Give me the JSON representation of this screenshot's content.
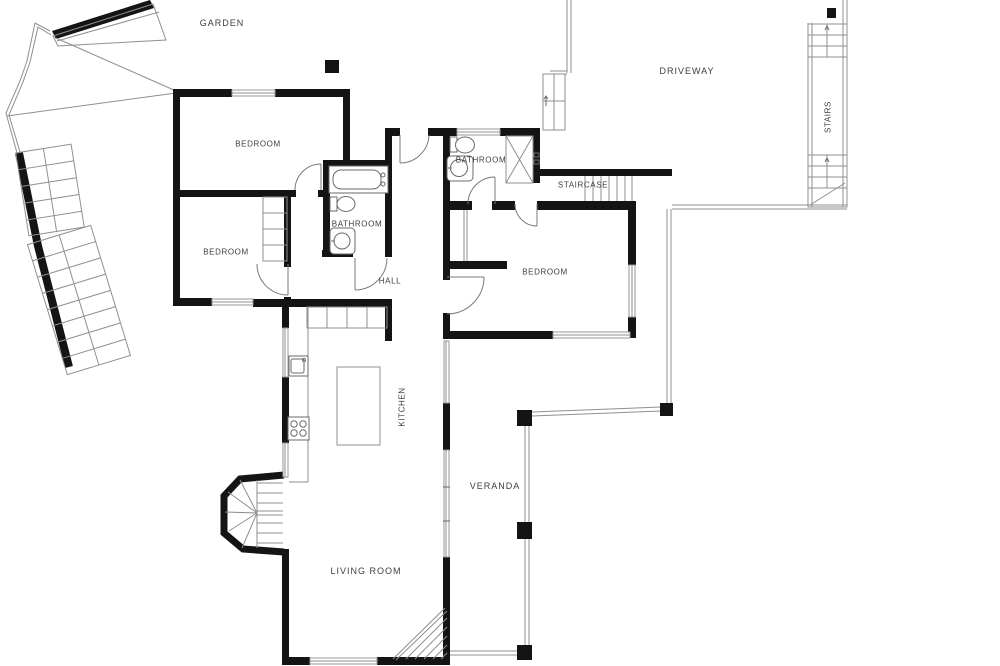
{
  "plan": {
    "labels": {
      "garden": "GARDEN",
      "driveway": "DRIVEWAY",
      "stairs": "STAIRS",
      "staircase": "STAIRCASE",
      "hall": "HALL",
      "kitchen": "KITCHEN",
      "veranda": "VERANDA",
      "living_room": "LIVING ROOM",
      "bedroom_top": "BEDROOM",
      "bedroom_left": "BEDROOM",
      "bedroom_right": "BEDROOM",
      "bathroom_left": "BATHROOM",
      "bathroom_right": "BATHROOM"
    },
    "colors": {
      "wall": "#141414",
      "thin": "#8f8f8f",
      "text": "#3d3d3d",
      "background": "#ffffff"
    }
  }
}
